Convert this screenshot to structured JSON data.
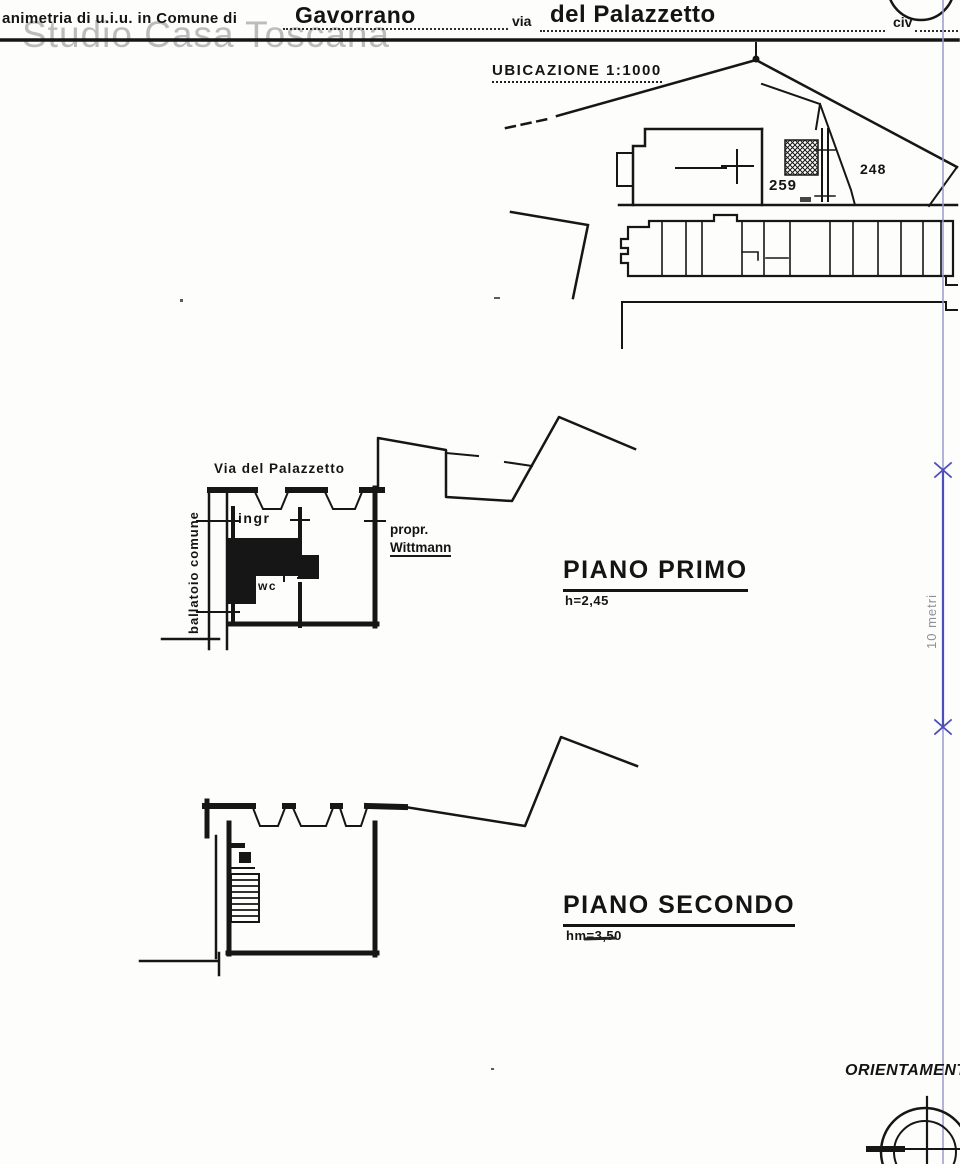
{
  "watermark": "Studio Casa Toscana",
  "header": {
    "title_label": "animetria di u.i.u. in Comune di",
    "comune_value": "Gavorrano",
    "street_label": "via",
    "street_value": "del Palazzetto",
    "civic_label": "civ"
  },
  "location_map": {
    "title": "UBICAZIONE 1:1000",
    "parcel_left": "259",
    "parcel_right": "248"
  },
  "floor_plan_first": {
    "street_label": "Via del Palazzetto",
    "balcony_label": "ballatoio comune",
    "entrance_label": "ingr",
    "wc_label": "wc",
    "owner_line1": "propr.",
    "owner_line2": "Wittmann",
    "title": "PIANO PRIMO",
    "height_note": "h=2,45"
  },
  "floor_plan_second": {
    "title": "PIANO SECONDO",
    "height_note": "hm=3,50"
  },
  "scale_bar": {
    "label": "10 metri"
  },
  "orientation": {
    "label": "ORIENTAMENTO"
  },
  "colors": {
    "ink": "#161616",
    "annotation_blue": "#4d4dbb",
    "guide_lavender": "#9a9ace",
    "watermark_gray": "#bcbcbc"
  }
}
